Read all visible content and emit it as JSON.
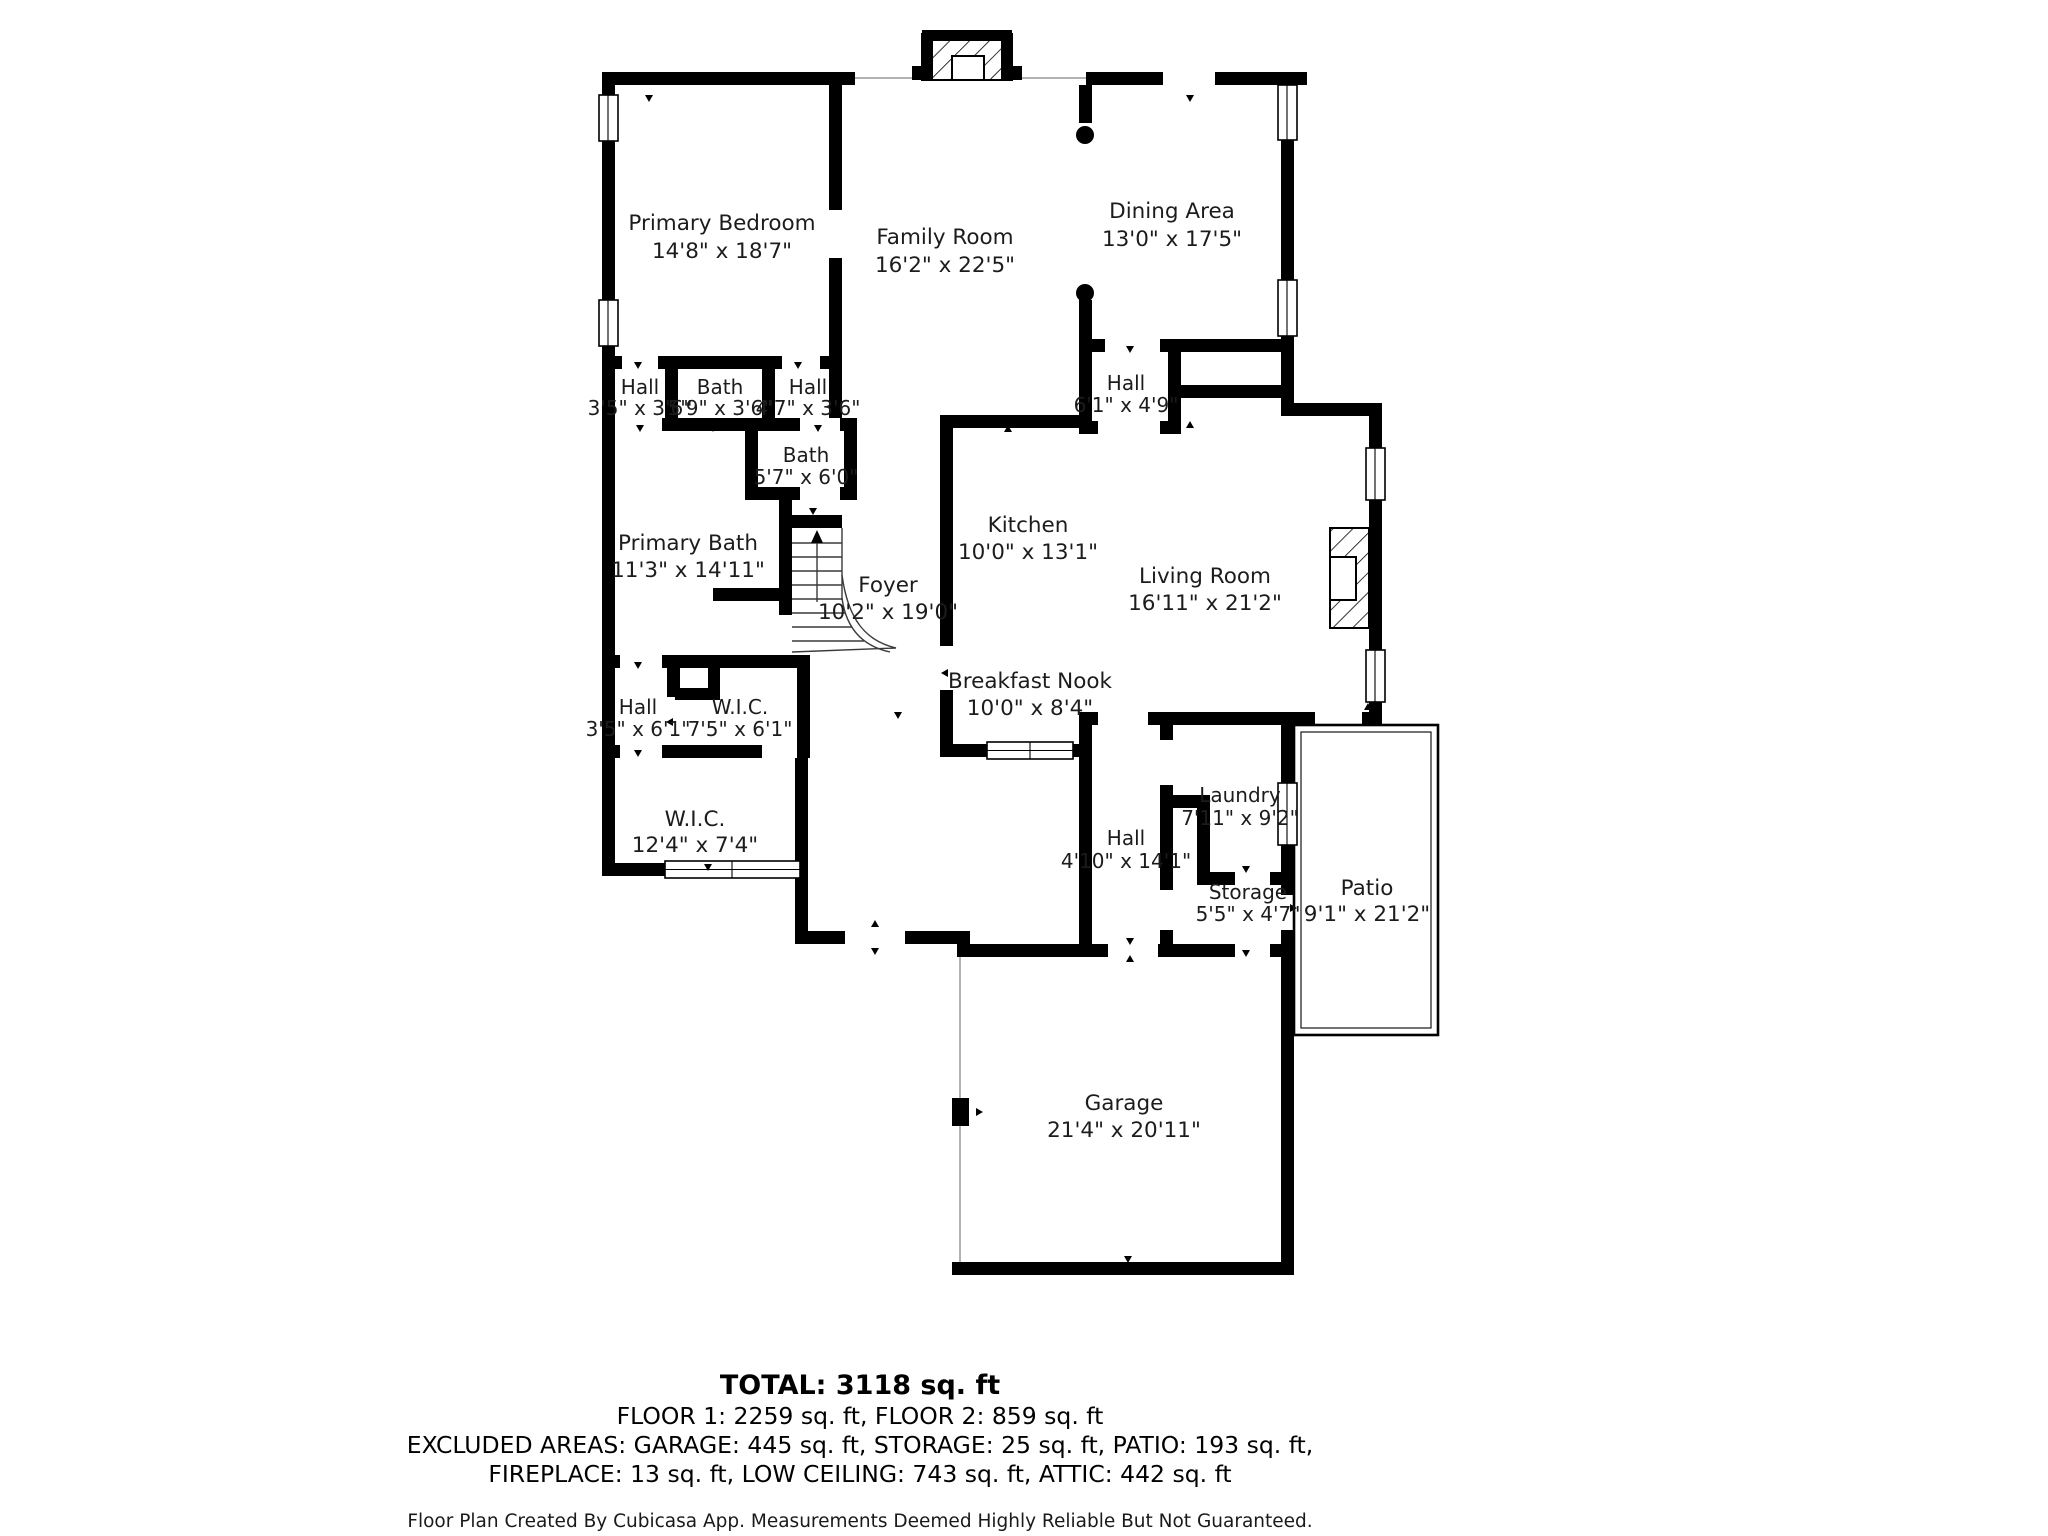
{
  "plan": {
    "title": "Floor plan",
    "colors": {
      "wall": "#000000",
      "text": "#1c1c1c",
      "background": "#ffffff"
    },
    "rooms": [
      {
        "id": "primary-bedroom",
        "name": "Primary Bedroom",
        "dims": "14'8\" x 18'7\""
      },
      {
        "id": "family-room",
        "name": "Family Room",
        "dims": "16'2\" x 22'5\""
      },
      {
        "id": "dining-area",
        "name": "Dining Area",
        "dims": "13'0\" x 17'5\""
      },
      {
        "id": "hall-upper-left",
        "name": "Hall",
        "dims": "3'5\" x 3'6\""
      },
      {
        "id": "bath-upper",
        "name": "Bath",
        "dims": "5'9\" x 3'6\""
      },
      {
        "id": "hall-upper-right",
        "name": "Hall",
        "dims": "4'7\" x 3'6\""
      },
      {
        "id": "bath-middle",
        "name": "Bath",
        "dims": "5'7\" x 6'0\""
      },
      {
        "id": "primary-bath",
        "name": "Primary Bath",
        "dims": "11'3\" x 14'11\""
      },
      {
        "id": "foyer",
        "name": "Foyer",
        "dims": "10'2\" x 19'0\""
      },
      {
        "id": "kitchen",
        "name": "Kitchen",
        "dims": "10'0\" x 13'1\""
      },
      {
        "id": "living-room",
        "name": "Living Room",
        "dims": "16'11\" x 21'2\""
      },
      {
        "id": "hall-dining",
        "name": "Hall",
        "dims": "6'1\" x 4'9\""
      },
      {
        "id": "breakfast-nook",
        "name": "Breakfast Nook",
        "dims": "10'0\" x 8'4\""
      },
      {
        "id": "hall-lower-left",
        "name": "Hall",
        "dims": "3'5\" x 6'1\""
      },
      {
        "id": "wic-small",
        "name": "W.I.C.",
        "dims": "7'5\" x 6'1\""
      },
      {
        "id": "wic-large",
        "name": "W.I.C.",
        "dims": "12'4\" x 7'4\""
      },
      {
        "id": "hall-garage",
        "name": "Hall",
        "dims": "4'10\" x 14'1\""
      },
      {
        "id": "laundry",
        "name": "Laundry",
        "dims": "7'11\" x 9'2\""
      },
      {
        "id": "storage",
        "name": "Storage",
        "dims": "5'5\" x 4'7\""
      },
      {
        "id": "patio",
        "name": "Patio",
        "dims": "9'1\" x 21'2\""
      },
      {
        "id": "garage",
        "name": "Garage",
        "dims": "21'4\" x 20'11\""
      }
    ],
    "summary": {
      "total": "TOTAL: 3118 sq. ft",
      "floors": "FLOOR 1: 2259 sq. ft, FLOOR 2: 859 sq. ft",
      "excluded_1": "EXCLUDED AREAS: GARAGE: 445 sq. ft, STORAGE: 25 sq. ft, PATIO: 193 sq. ft,",
      "excluded_2": "FIREPLACE: 13 sq. ft, LOW CEILING: 743 sq. ft, ATTIC: 442 sq. ft",
      "credit": "Floor Plan Created By Cubicasa App. Measurements Deemed Highly Reliable But Not Guaranteed."
    }
  }
}
